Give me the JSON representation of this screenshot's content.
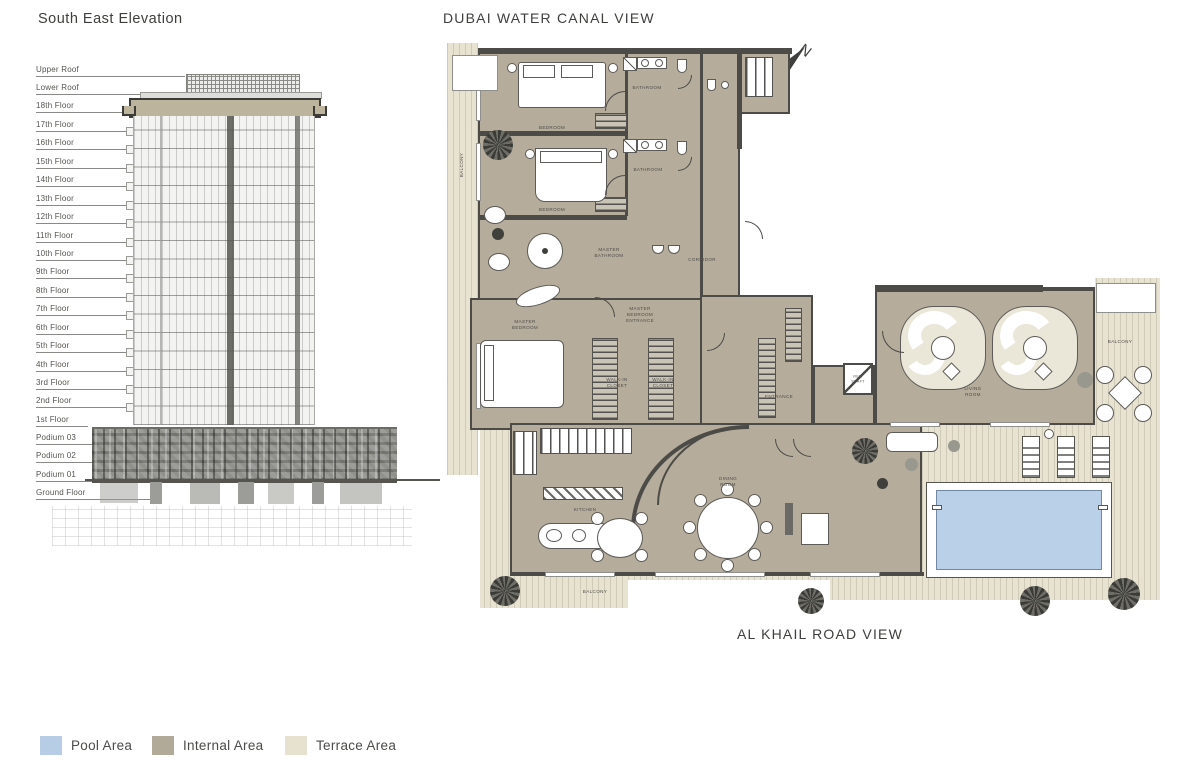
{
  "elevation": {
    "title": "South East Elevation",
    "floors": [
      "Upper Roof",
      "Lower Roof",
      "18th Floor",
      "17th Floor",
      "16th Floor",
      "15th Floor",
      "14th Floor",
      "13th Floor",
      "12th Floor",
      "11th Floor",
      "10th Floor",
      "9th Floor",
      "8th Floor",
      "7th Floor",
      "6th Floor",
      "5th Floor",
      "4th Floor",
      "3rd Floor",
      "2nd Floor",
      "1st Floor",
      "Podium 03",
      "Podium 02",
      "Podium 01",
      "Ground Floor"
    ]
  },
  "floorplan": {
    "title_top": "DUBAI WATER CANAL VIEW",
    "title_bottom": "AL KHAIL ROAD VIEW",
    "compass_label": "N",
    "rooms": [
      {
        "label": "BEDROOM"
      },
      {
        "label": "BATHROOM"
      },
      {
        "label": "BEDROOM"
      },
      {
        "label": "BATHROOM"
      },
      {
        "label": "MASTER BATHROOM"
      },
      {
        "label": "MASTER BEDROOM"
      },
      {
        "label": "MASTER BEDROOM ENTRANCE"
      },
      {
        "label": "WALK-IN CLOSET"
      },
      {
        "label": "WALK-IN CLOSET"
      },
      {
        "label": "CORRIDOR"
      },
      {
        "label": "ENTRANCE"
      },
      {
        "label": "REF. SHAFT"
      },
      {
        "label": "LIVING ROOM"
      },
      {
        "label": "KITCHEN"
      },
      {
        "label": "DINING ROOM"
      },
      {
        "label": "BALCONY"
      },
      {
        "label": "BALCONY"
      },
      {
        "label": "BALCONY"
      }
    ]
  },
  "legend": {
    "items": [
      {
        "label": "Pool Area",
        "color": "#b7cde6"
      },
      {
        "label": "Internal Area",
        "color": "#b2aa99"
      },
      {
        "label": "Terrace Area",
        "color": "#e7e1cf"
      }
    ]
  },
  "colors": {
    "pool": "#b9d0e8",
    "internal": "#b5ac9b",
    "terrace": "#e8e2d0",
    "wall": "#4c4b47"
  }
}
